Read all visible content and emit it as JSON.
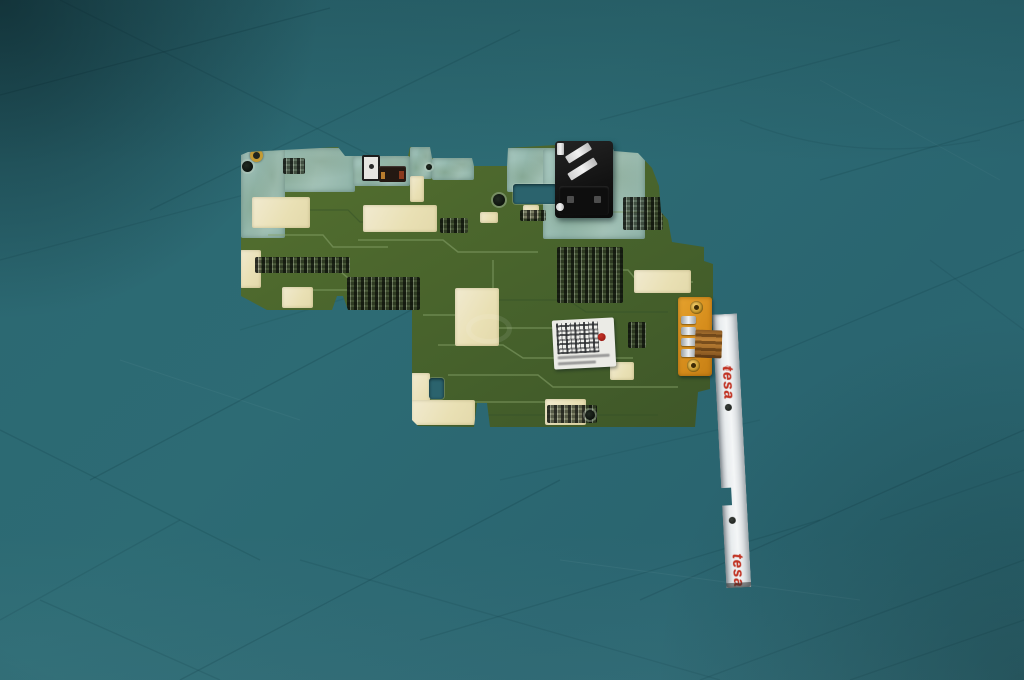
{
  "image": {
    "type": "photograph",
    "subject": "Disassembled smartphone motherboard PCB with headphone jack, barcode sticker and attached side-key flex cable strip, lying on a teal fabric background",
    "width": 1024,
    "height": 680
  },
  "visible_text": {
    "tape_brand": "tesa",
    "tape_brand_reg": "®",
    "tape_brand_bottom_partial": "tesa"
  },
  "palette": {
    "background_fabric": "#2c6a73",
    "fabric_crease_line": "#14424b",
    "pcb_green": "#4b6930",
    "pcb_green_dark": "#3e5628",
    "rf_shield_pale_teal": "#a3c4ba",
    "solder_pad_cream": "#ece4bc",
    "audio_jack_black": "#141414",
    "metal_silver": "#e8ecee",
    "flex_connector_orange": "#d68d1c",
    "copper_flex": "#b5752f",
    "label_white": "#ebebe6",
    "inspection_dot_red": "#a01616",
    "tape_grey": "#dfe3e6",
    "tesa_red": "#c23222"
  },
  "scene_parts": {
    "board": "smartphone motherboard",
    "jack": "3.5mm headphone jack",
    "label": "QR/data-matrix sticker with red inspection dot and illegible micro-text",
    "connector": "orange board-to-board flex connector with silver pins and two gold screws",
    "strip": "silver side-key flex cable covered with tesa tape"
  }
}
